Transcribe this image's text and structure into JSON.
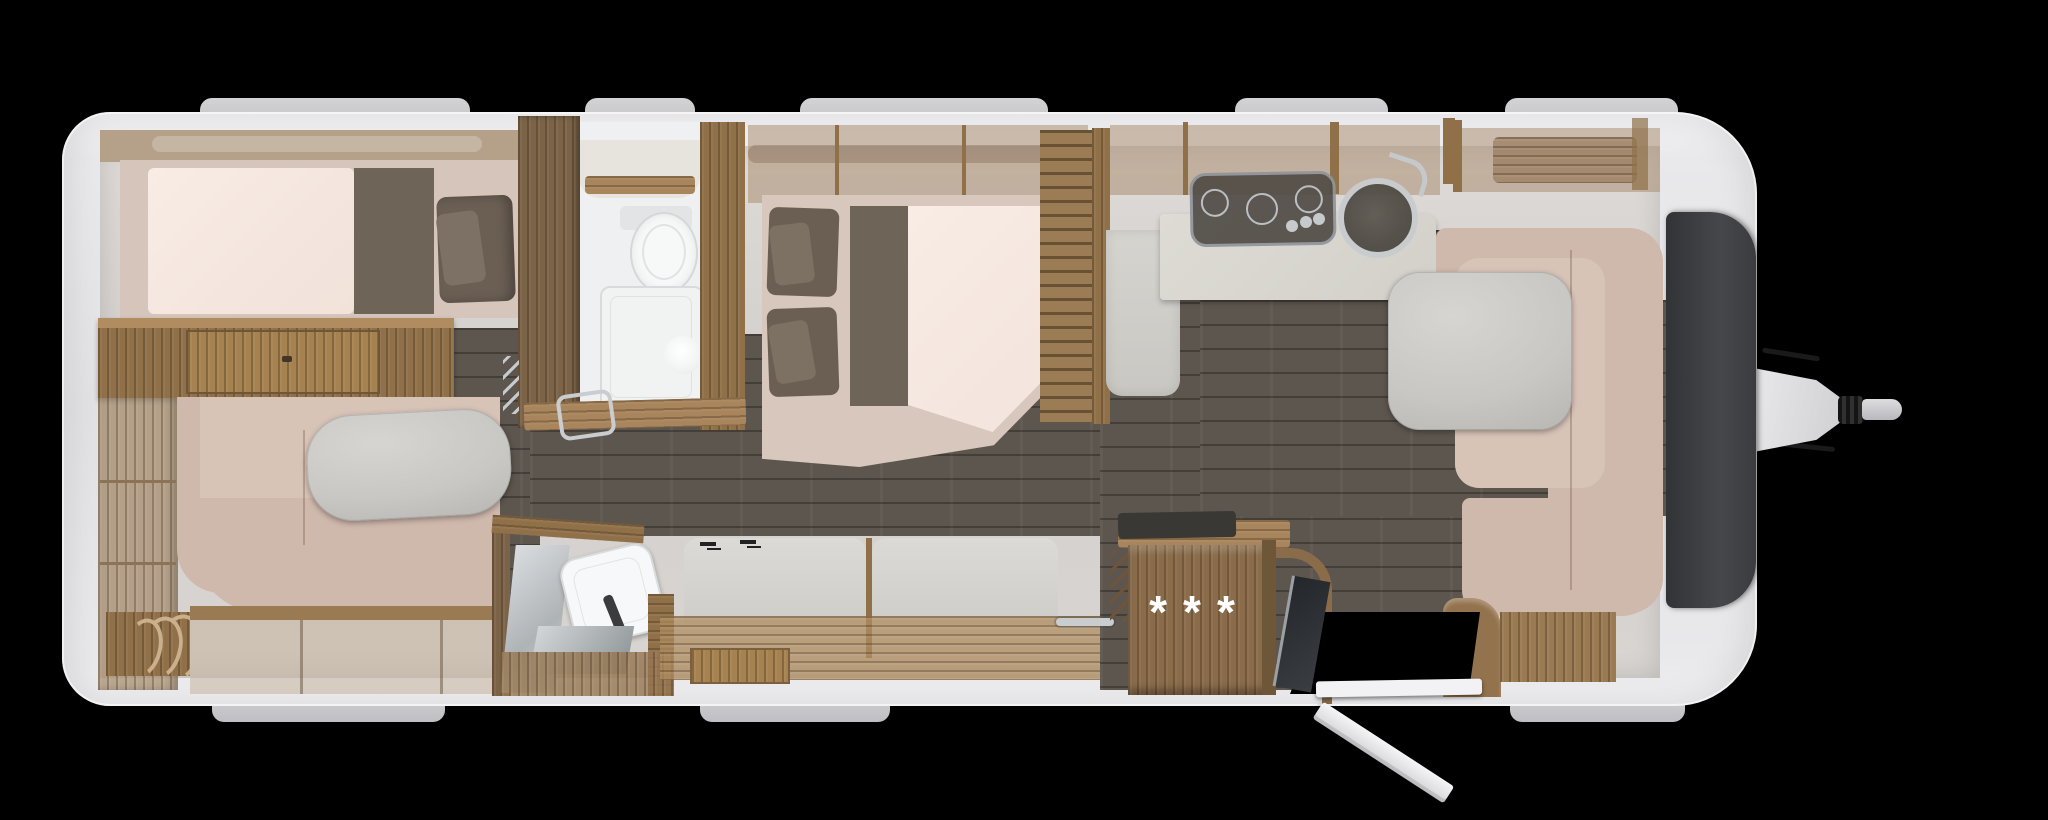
{
  "scene": {
    "description": "caravan-floor-plan-top-view",
    "background_color": "#000000",
    "marker": {
      "options_label": "***"
    }
  },
  "colors": {
    "body_shell": "#eef0f2",
    "front_panel": "#3d3f42",
    "interior_wall": "#d8d4d1",
    "floor_wood": "#5d564e",
    "cabinet_wood_dark": "#7b6347",
    "cabinet_wood_mid": "#8f7049",
    "cabinet_wood_light": "#a8855c",
    "upholstery_pink": "#cfb8ac",
    "mattress": "#f6e9e2",
    "bedding_dark": "#6b5f54",
    "table_gray": "#c8c7c3",
    "kitchen_counter": "#dbd8d2",
    "sanitary_white": "#f2f4f4",
    "chrome": "#c9cdd0"
  },
  "rooms": {
    "rear_bedroom": [
      "single-bed",
      "pillows",
      "sideboard",
      "shelf-unit",
      "lounge-sofa",
      "lounge-table"
    ],
    "bathroom": [
      "toilet",
      "shower-tray",
      "shower-light",
      "vanity-shelf",
      "towel-bar",
      "concertina-door"
    ],
    "middle_bedroom": [
      "french-bed",
      "pillows",
      "bed-runner",
      "louvered-wardrobe",
      "overhead-cabinets"
    ],
    "kitchen": [
      "three-burner-hob",
      "round-sink",
      "faucet",
      "worktop",
      "side-panel"
    ],
    "dinette": [
      "u-shaped-sofa",
      "dinette-table",
      "overhead-shelf",
      "bench-fronts"
    ],
    "entry": [
      "entrance-door-open",
      "door-sill",
      "grab-rail",
      "marked-cabinet",
      "towel-rail"
    ],
    "washroom": [
      "wash-basin",
      "mirror",
      "vanity-counter",
      "wardrobe-panels",
      "clothes-hooks",
      "drawer"
    ],
    "exterior": [
      "roof-windows",
      "drawbar-hitch",
      "coupling-head",
      "front-panel"
    ]
  }
}
